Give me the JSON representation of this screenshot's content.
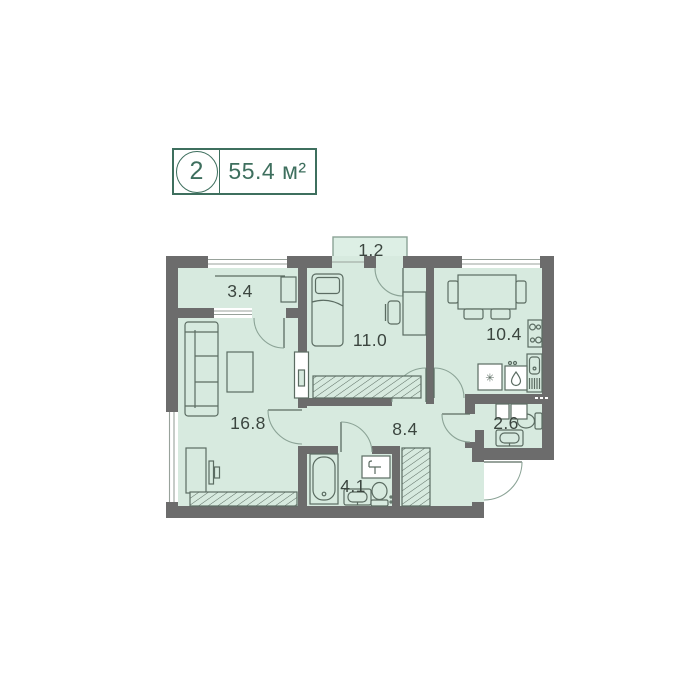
{
  "badge": {
    "room_count": "2",
    "area_label": "55.4 м²"
  },
  "rooms": [
    {
      "id": "balcony",
      "area": "1.2"
    },
    {
      "id": "loggia",
      "area": "3.4"
    },
    {
      "id": "bedroom",
      "area": "11.0"
    },
    {
      "id": "kitchen",
      "area": "10.4"
    },
    {
      "id": "wc",
      "area": "2.6"
    },
    {
      "id": "hallway",
      "area": "8.4"
    },
    {
      "id": "bathroom",
      "area": "4.1"
    },
    {
      "id": "living_room",
      "area": "16.8"
    }
  ],
  "icons": {
    "asterisk_symbol": "✳"
  },
  "colors": {
    "wall": "#6c6c6c",
    "room_fill": "#d7eadf",
    "balcony_fill": "#ddefe5",
    "accent": "#3e6f5e",
    "furniture_stroke": "#5b6c62",
    "door_stroke": "#8ba396",
    "window_line": "#98a29b",
    "label_text": "#3b453f"
  }
}
